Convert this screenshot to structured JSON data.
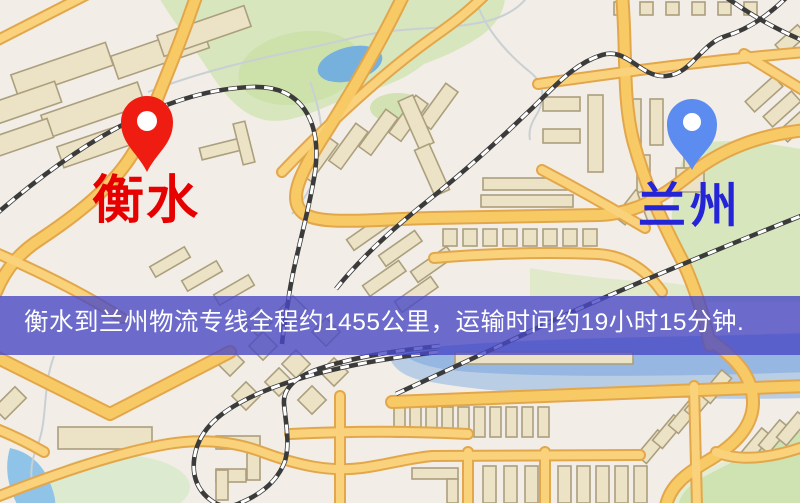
{
  "map": {
    "markers": {
      "origin": {
        "name": "衡水",
        "label_color": "#e60000",
        "pin_color": "#ee1c11",
        "pin_hole_color": "#ffffff"
      },
      "destination": {
        "name": "兰州",
        "label_color": "#2424d8",
        "pin_color": "#5c8cf0",
        "pin_hole_color": "#ffffff"
      }
    },
    "banner": {
      "text": "衡水到兰州物流专线全程约1455公里，运输时间约19小时15分钟.",
      "background_color": "#4a4ac6",
      "text_color": "#ffffff",
      "distance_text": "约1455公里",
      "duration_text": "约19小时15分钟"
    },
    "palette": {
      "background": "#f2ede6",
      "road_fill": "#f8ca66",
      "road_casing": "#e3a74b",
      "building_fill": "#ece3c6",
      "building_outline": "#ab9f7e",
      "park_green": "#d7e6bd",
      "water_blue": "#76b1dd",
      "railway_dark": "#3b3b3b"
    }
  }
}
